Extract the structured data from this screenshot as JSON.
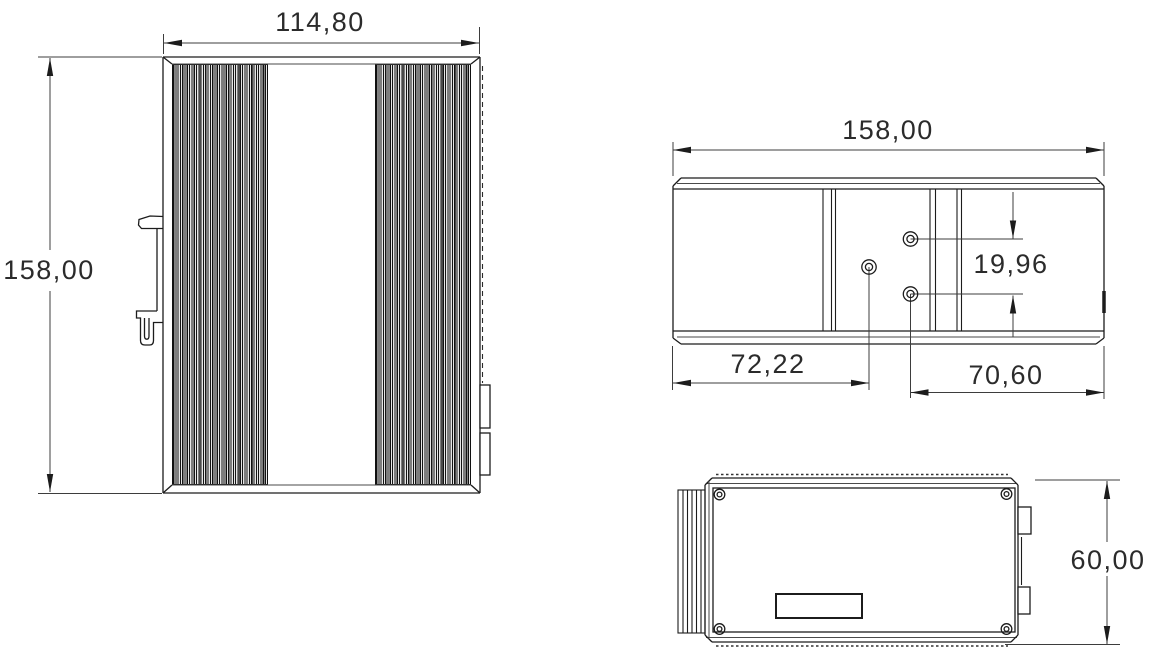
{
  "drawing": {
    "views": {
      "front": {
        "labels": {
          "width": "114,80",
          "height": "158,00"
        }
      },
      "top": {
        "labels": {
          "width": "158,00",
          "hole_offset_left": "72,22",
          "hole_offset_right": "70,60",
          "hole_spacing": "19,96"
        }
      },
      "side": {
        "labels": {
          "height": "60,00"
        }
      }
    },
    "colors": {
      "line": "#1c1c1c",
      "dim_line": "#3d3d3d",
      "text": "#2b2b2b",
      "fin_dark": "#141414",
      "fin_light": "#e6e6e6",
      "background": "#ffffff"
    }
  }
}
